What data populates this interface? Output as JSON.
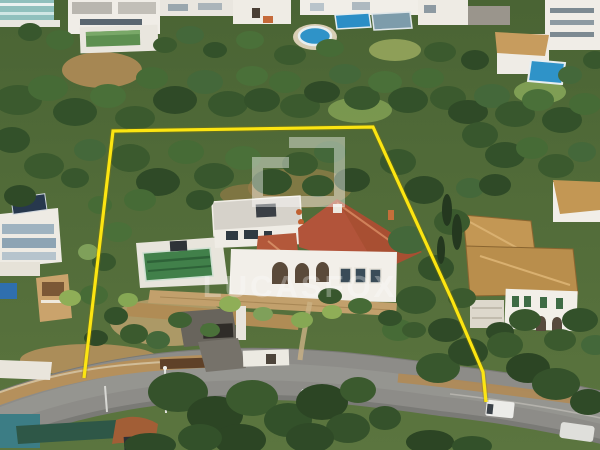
{
  "page": {
    "type": "aerial-property-photograph",
    "description": "drone view of a coastal hillside villa plot outlined in yellow",
    "width": 600,
    "height": 450
  },
  "watermark": {
    "text": "LUCASFOX",
    "logo_name": "lucasfox-square-logo",
    "color": "#ffffff",
    "text_opacity": "0.30",
    "logo_opacity": "0.42"
  },
  "boundary": {
    "name": "property-boundary-overlay",
    "color": "#fce511",
    "shadow_color": "#8a7a00",
    "vertices": "84,378 113,131 373,127 452,300 483,372 486,402"
  },
  "palette": {
    "road_asphalt": "#8d8c88",
    "road_worn": "#9e9d98",
    "roof_terracotta": "#b2543a",
    "roof_terracotta_small": "#b3583a",
    "roof_sand": "#c39754",
    "wall_white": "#f2efe9",
    "deck_white": "#e8e5dc",
    "pool_green": "#41804a",
    "pool_blue": "#2f93c8",
    "dirt_tan": "#b5905c",
    "forest_base_top": "#4a6434",
    "forest_base_bottom": "#5b753f"
  },
  "scene": {
    "objects": [
      "main-villa",
      "green-swimming-pool",
      "pool-deck",
      "arched-facade",
      "terracotta-roof",
      "flat-roof-wing",
      "stone-terraces",
      "driveway-garage",
      "neighbor-house-left",
      "neighbor-villa-right",
      "neighbor-houses-top",
      "round-blue-pool",
      "rect-blue-pools",
      "curving-road",
      "white-van",
      "white-van-right",
      "dark-car",
      "street-lamp",
      "teal-tarp",
      "green-fence",
      "pine-forest",
      "palm-trees",
      "cypress-trees"
    ]
  }
}
